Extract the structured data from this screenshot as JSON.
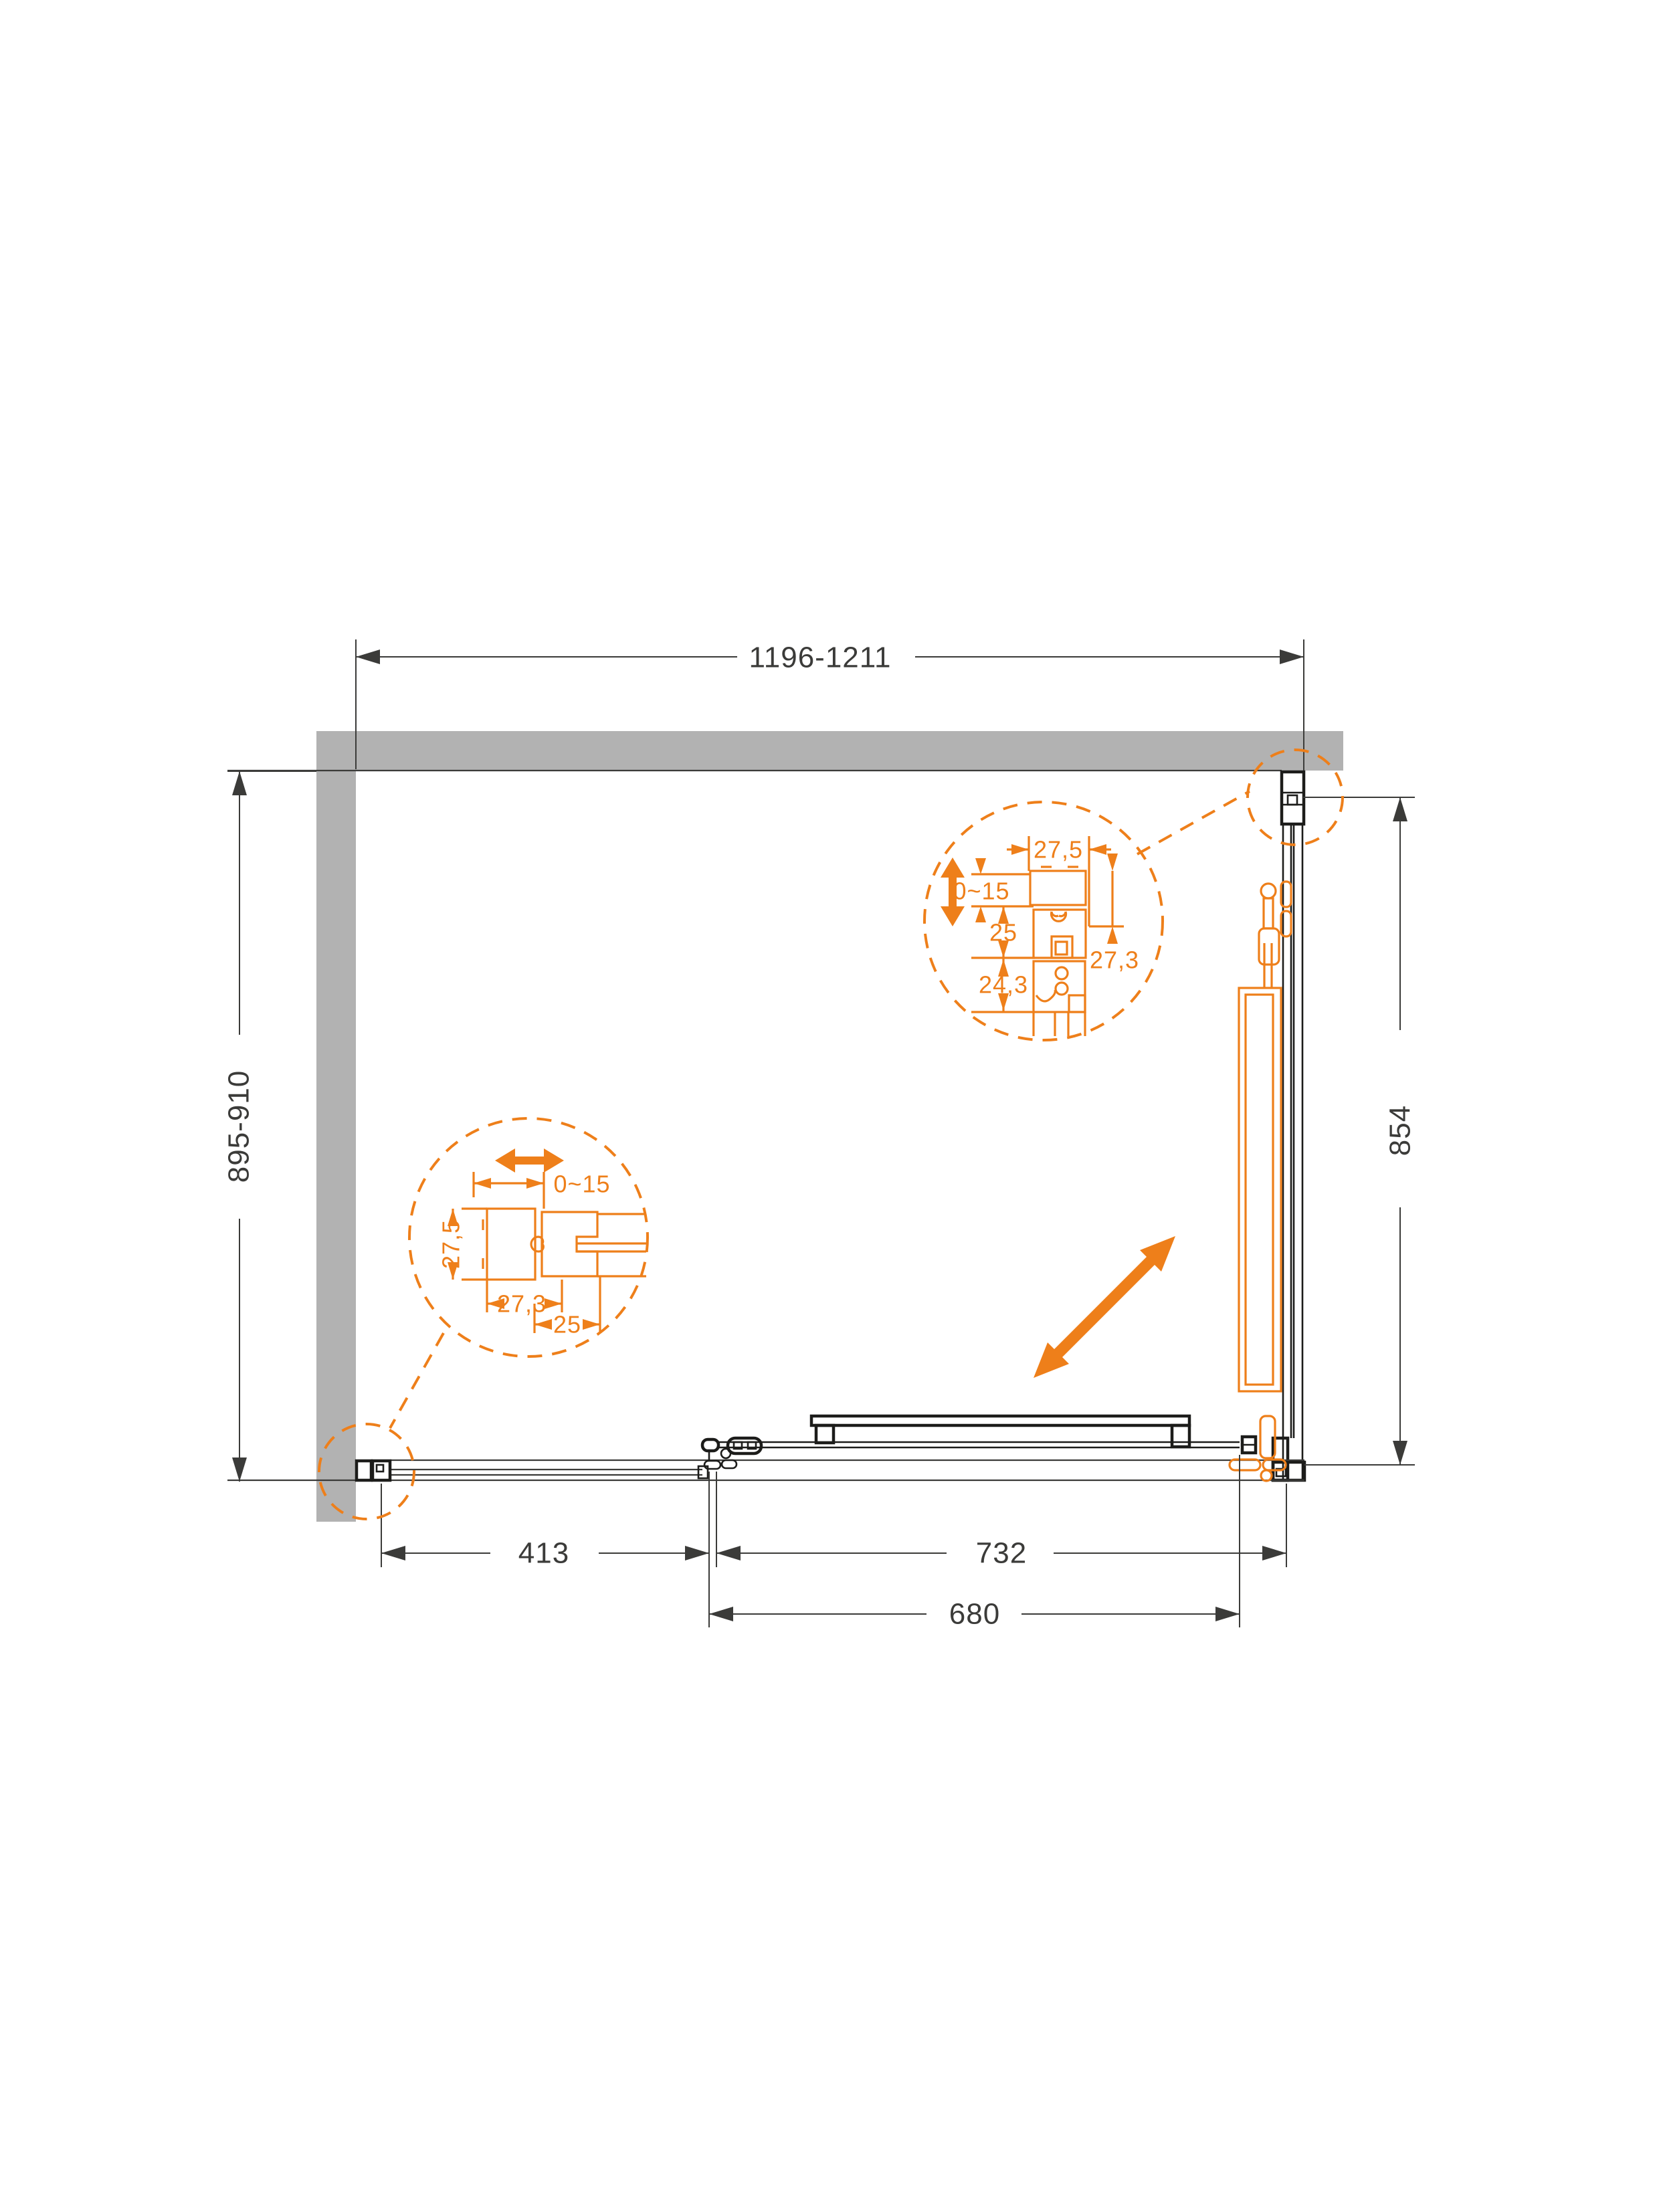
{
  "drawing_title": "shower-enclosure-plan-technical-drawing",
  "colors": {
    "accent": "#EE7F1A",
    "wall": "#B2B2B2",
    "line": "#3B3B39",
    "profile": "#1C1C1A"
  },
  "dimensions": {
    "top_width_range": "1196-1211",
    "left_depth_range": "895-910",
    "right_side_glass": "854",
    "bottom_fixed_glass": "413",
    "bottom_opening": "732",
    "bottom_door_glass": "680"
  },
  "detail_top": {
    "profile_width": "27,5",
    "wall_adjustment": "0~15",
    "insert_depth": "25",
    "roller_depth": "24,3",
    "profile_depth": "27,3"
  },
  "detail_left": {
    "wall_adjustment": "0~15",
    "profile_height": "27,5",
    "profile_width": "27,3",
    "insert_width": "25"
  }
}
